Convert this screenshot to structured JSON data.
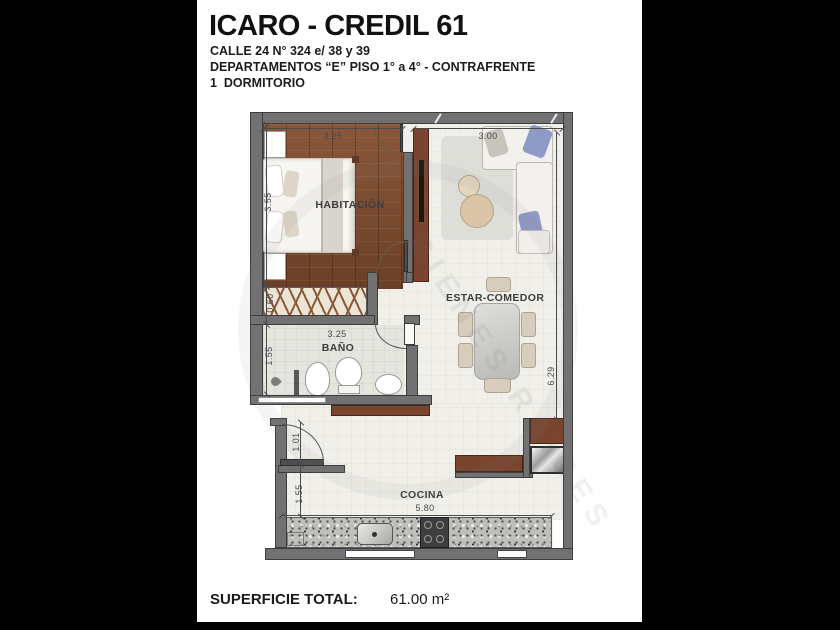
{
  "header": {
    "title": "ICARO - CREDIL 61",
    "address": "CALLE 24 N° 324 e/ 38 y 39",
    "building_line": "DEPARTAMENTOS “E” PISO 1° a 4° - CONTRAFRENTE",
    "bedrooms_line": "1  DORMITORIO"
  },
  "rooms": {
    "bedroom": "HABITACIÓN",
    "living_dining": "ESTAR-COMEDOR",
    "bathroom": "BAÑO",
    "kitchen": "COCINA"
  },
  "dimensions": {
    "bedroom_width": "3.25",
    "bedroom_depth": "3.55",
    "living_width": "3.00",
    "living_depth": "6.29",
    "closet_depth": "0.60",
    "bathroom_width": "3.25",
    "bathroom_depth": "1.55",
    "entry_width": "1.01",
    "kitchen_depth": "1.55",
    "kitchen_width": "5.80"
  },
  "footer": {
    "label": "SUPERFICIE TOTAL:",
    "value": "61.00 m²"
  },
  "watermark": {
    "text": "BIENES RAICES"
  },
  "colors": {
    "wall": "#717171",
    "wood_floor": "#7c4b2e",
    "light_floor": "#f0efe9",
    "cabinet_brown": "#7a452f",
    "pillow_blue": "#8f9ac7",
    "letterbox": "#000000"
  }
}
